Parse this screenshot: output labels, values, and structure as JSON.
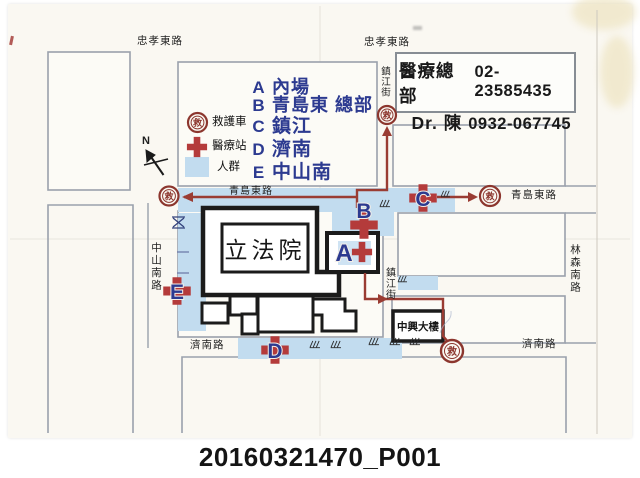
{
  "caption": "20160321470_P001",
  "glyphs": {
    "ambulance": "救",
    "north": "N"
  },
  "legend": {
    "ambulance_label": "救護車",
    "aid_station_label": "醫療站",
    "crowd_label": "人群",
    "stations": [
      {
        "letter": "A",
        "name": "內場"
      },
      {
        "letter": "B",
        "name": "青島東 總部"
      },
      {
        "letter": "C",
        "name": "鎮江"
      },
      {
        "letter": "D",
        "name": "濟南"
      },
      {
        "letter": "E",
        "name": "中山南"
      }
    ]
  },
  "info_box": {
    "hq_label": "醫療總部",
    "hq_phone": "02-23585435",
    "doctor_label": "Dr. 陳",
    "doctor_phone": "0932-067745"
  },
  "streets": {
    "zhongxiao_e_left": "忠孝東路",
    "zhongxiao_e_right": "忠孝東路",
    "qingdao_e_mid": "青島東路",
    "qingdao_e_right": "青島東路",
    "jinan_left": "濟南路",
    "jinan_right": "濟南路",
    "zhongshan_s": "中山南路",
    "zhenjiang_top": "鎮江街",
    "zhenjiang_mid": "鎮江街",
    "linsen_s": "林森南路"
  },
  "buildings": {
    "legislative_yuan": "立法院",
    "zhongxing_building": "中興大樓"
  },
  "colors": {
    "station_blue": "#2c3a90",
    "cross_red": "#b43b3b",
    "ambulance_maroon": "#8c362e",
    "route_red": "#9a3c33",
    "crowd_blue": "#c2dcef",
    "road_gray": "#9aa1ac"
  }
}
